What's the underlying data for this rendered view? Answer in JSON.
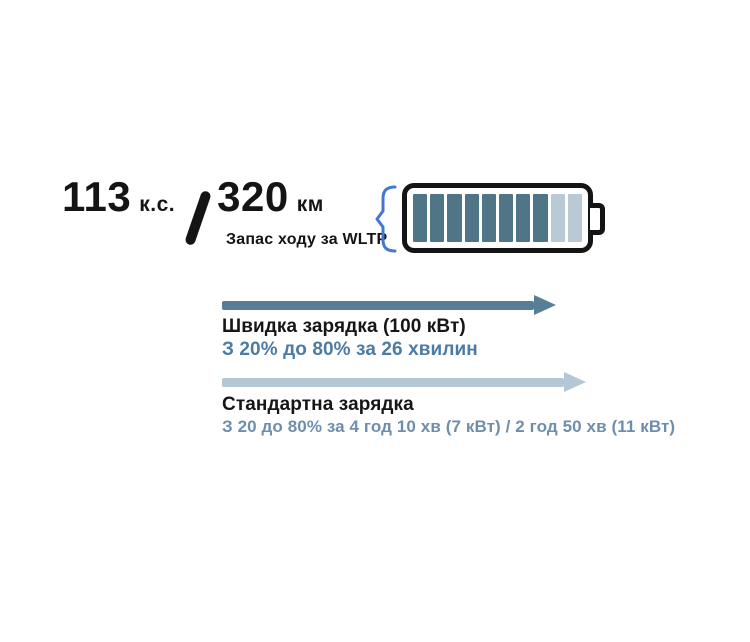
{
  "header": {
    "power_value": "113",
    "power_unit": "к.с.",
    "range_value": "320",
    "range_unit": "км",
    "range_caption": "Запас ходу за WLTP"
  },
  "battery": {
    "total_segments": 10,
    "filled_segments": 8,
    "filled_color": "#4e7686",
    "empty_color": "#b9c9d5",
    "brace_color": "#4478cf",
    "outline_color": "#141414"
  },
  "fast_charging": {
    "title": "Швидка зарядка (100 кВт)",
    "subtitle": "З 20% до 80% за 26 хвилин",
    "arrow_color": "#567e96",
    "subtitle_color": "#4c7ba4"
  },
  "standard_charging": {
    "title": "Стандартна зарядка",
    "subtitle": "З 20 до 80% за 4 год 10 хв (7 кВт) / 2 год 50 хв (11 кВт)",
    "arrow_color": "#b4c7d5",
    "subtitle_color": "#6e8eac"
  }
}
